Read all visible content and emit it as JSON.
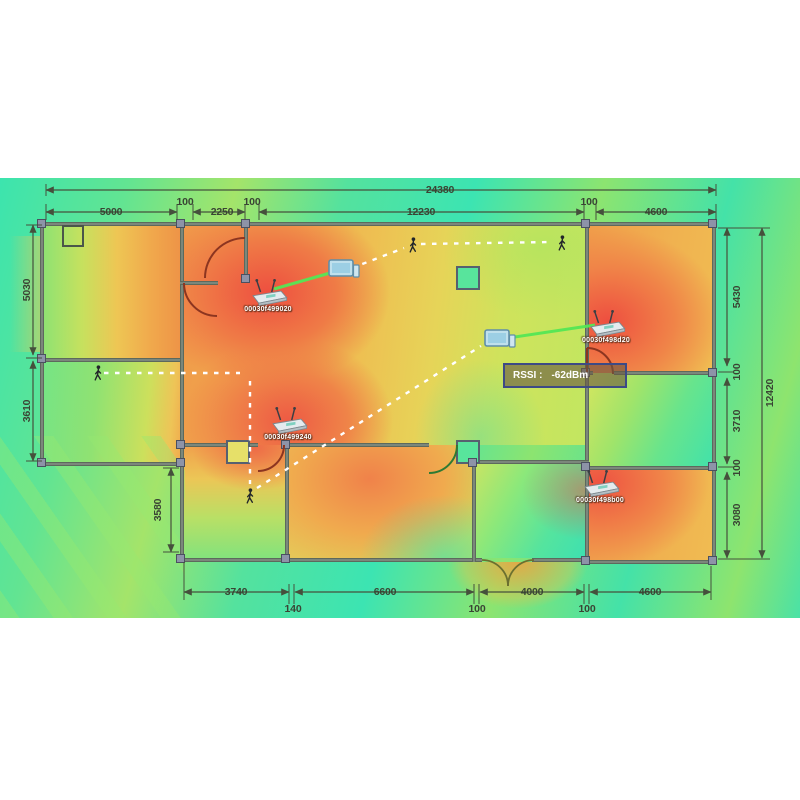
{
  "dims": {
    "top_total": "24380",
    "top": [
      "5000",
      "100",
      "2250",
      "100",
      "12230",
      "100",
      "4600"
    ],
    "left": [
      "5030",
      "3610",
      "3580"
    ],
    "right": [
      "5430",
      "100",
      "3710",
      "100",
      "3080"
    ],
    "right_total": "12420",
    "bottom": [
      "3740",
      "140",
      "6600",
      "100",
      "4000",
      "100",
      "4600"
    ]
  },
  "aps": [
    {
      "label": "00030f499020"
    },
    {
      "label": "00030f498d20"
    },
    {
      "label": "00030f499240"
    },
    {
      "label": "00030f498b00"
    }
  ],
  "tooltip": {
    "label": "RSSI :",
    "value": "-62dBm"
  },
  "icons": {
    "router": "wifi-router-icon",
    "laptop": "laptop-icon",
    "walker": "walker-icon",
    "pillar": "pillar-block",
    "door": "door-arc"
  },
  "colors": {
    "heat_hot": "#ee4f40",
    "heat_warm": "#f0a84d",
    "heat_mid": "#e6d458",
    "heat_cool": "#8ce470",
    "heat_cold": "#3ce4ae",
    "link_line": "#55e755",
    "walk_path": "#ffffff",
    "tooltip_border": "#3d4a85"
  }
}
